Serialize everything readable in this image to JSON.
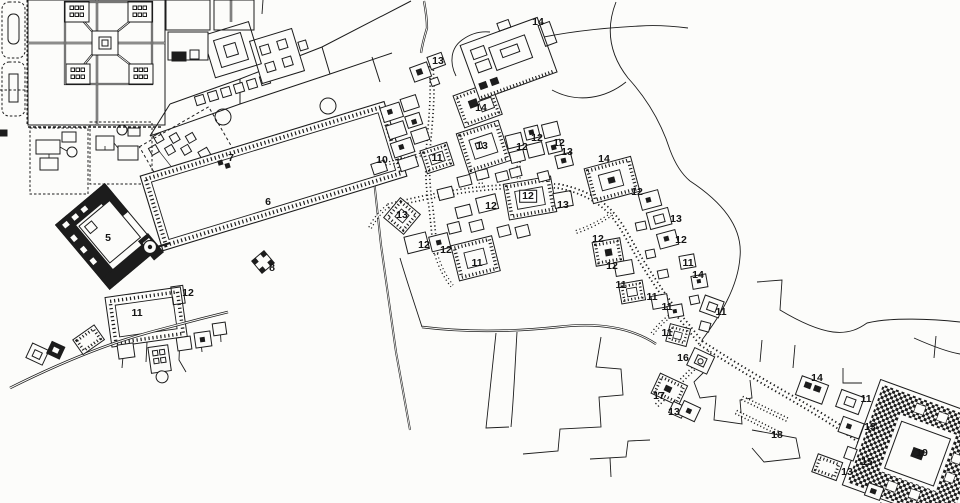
{
  "map": {
    "description": "Archaeological site plan, black ink line drawing on white paper, with numbered buildings, walled gardens, a large rectangular maydan, dense town blocks and hatched bazaar streets",
    "colors": {
      "ink": "#1c1c1c",
      "paper": "#fcfcfa"
    },
    "labels": [
      {
        "text": "14",
        "x": 538,
        "y": 22
      },
      {
        "text": "13",
        "x": 438,
        "y": 61
      },
      {
        "text": "14",
        "x": 481,
        "y": 108
      },
      {
        "text": "12",
        "x": 522,
        "y": 147
      },
      {
        "text": "12",
        "x": 537,
        "y": 138
      },
      {
        "text": "12",
        "x": 559,
        "y": 143
      },
      {
        "text": "13",
        "x": 567,
        "y": 152
      },
      {
        "text": "7",
        "x": 231,
        "y": 158
      },
      {
        "text": "10",
        "x": 382,
        "y": 160
      },
      {
        "text": "11",
        "x": 437,
        "y": 158
      },
      {
        "text": "13",
        "x": 482,
        "y": 146
      },
      {
        "text": "14",
        "x": 604,
        "y": 159
      },
      {
        "text": "12",
        "x": 637,
        "y": 192
      },
      {
        "text": "6",
        "x": 268,
        "y": 202
      },
      {
        "text": "12",
        "x": 528,
        "y": 196,
        "boxed": true
      },
      {
        "text": "13",
        "x": 563,
        "y": 205
      },
      {
        "text": "12",
        "x": 491,
        "y": 206
      },
      {
        "text": "13",
        "x": 402,
        "y": 215
      },
      {
        "text": "13",
        "x": 676,
        "y": 219
      },
      {
        "text": "5",
        "x": 108,
        "y": 238
      },
      {
        "text": "12",
        "x": 598,
        "y": 239
      },
      {
        "text": "12",
        "x": 681,
        "y": 240
      },
      {
        "text": "12",
        "x": 424,
        "y": 245
      },
      {
        "text": "12",
        "x": 446,
        "y": 250
      },
      {
        "text": "11",
        "x": 477,
        "y": 263
      },
      {
        "text": "11",
        "x": 688,
        "y": 263
      },
      {
        "text": "8",
        "x": 272,
        "y": 268
      },
      {
        "text": "12",
        "x": 612,
        "y": 266
      },
      {
        "text": "14",
        "x": 698,
        "y": 275
      },
      {
        "text": "11",
        "x": 621,
        "y": 285
      },
      {
        "text": "12",
        "x": 188,
        "y": 293
      },
      {
        "text": "11",
        "x": 652,
        "y": 297
      },
      {
        "text": "11",
        "x": 667,
        "y": 307
      },
      {
        "text": "11",
        "x": 137,
        "y": 313
      },
      {
        "text": "11",
        "x": 721,
        "y": 312
      },
      {
        "text": "11",
        "x": 667,
        "y": 333
      },
      {
        "text": "16",
        "x": 683,
        "y": 358
      },
      {
        "text": "14",
        "x": 817,
        "y": 378
      },
      {
        "text": "17",
        "x": 659,
        "y": 396
      },
      {
        "text": "11",
        "x": 866,
        "y": 399
      },
      {
        "text": "13",
        "x": 674,
        "y": 412
      },
      {
        "text": "13",
        "x": 870,
        "y": 427
      },
      {
        "text": "18",
        "x": 777,
        "y": 435
      },
      {
        "text": "19",
        "x": 922,
        "y": 453
      },
      {
        "text": "15",
        "x": 867,
        "y": 462
      },
      {
        "text": "13",
        "x": 847,
        "y": 472
      }
    ]
  }
}
